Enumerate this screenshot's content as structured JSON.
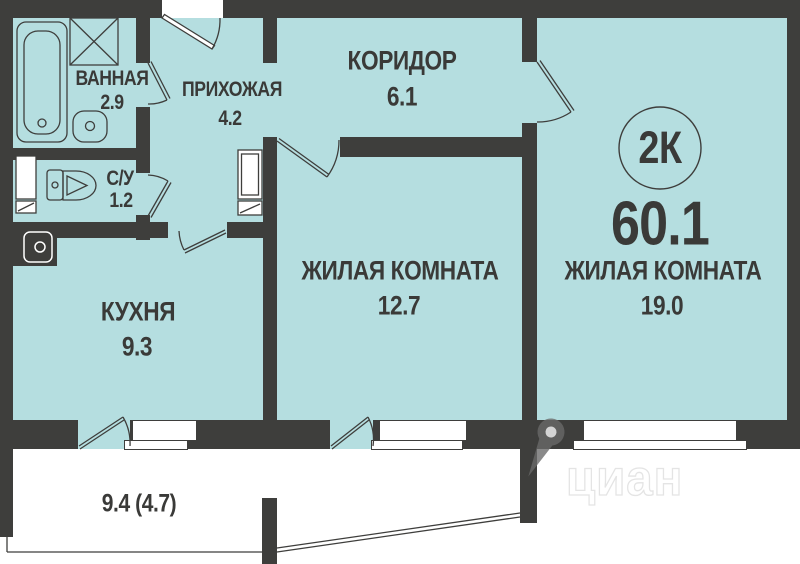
{
  "plan": {
    "type_badge": "2К",
    "total_area": "60.1",
    "rooms": [
      {
        "id": "bathroom",
        "name": "ВАННАЯ",
        "area": "2.9"
      },
      {
        "id": "wc",
        "name": "С/У",
        "area": "1.2"
      },
      {
        "id": "hallway",
        "name": "ПРИХОЖАЯ",
        "area": "4.2"
      },
      {
        "id": "corridor",
        "name": "КОРИДОР",
        "area": "6.1"
      },
      {
        "id": "kitchen",
        "name": "КУХНЯ",
        "area": "9.3"
      },
      {
        "id": "living1",
        "name": "ЖИЛАЯ КОМНАТА",
        "area": "12.7"
      },
      {
        "id": "living2",
        "name": "ЖИЛАЯ КОМНАТА",
        "area": "19.0"
      }
    ],
    "balcony": {
      "area_label": "9.4 (4.7)"
    },
    "fixtures": [
      "bathtub-icon",
      "washing-machine-icon",
      "bath-sink-icon",
      "toilet-icon",
      "kitchen-sink-icon",
      "wardrobe-icon",
      "cabinet-icon"
    ],
    "watermark": {
      "text": "циан",
      "icon": "map-pin-icon"
    },
    "colors": {
      "wall": "#3e3e3c",
      "floor": "#b5dee0",
      "text": "#3a3a38"
    }
  }
}
